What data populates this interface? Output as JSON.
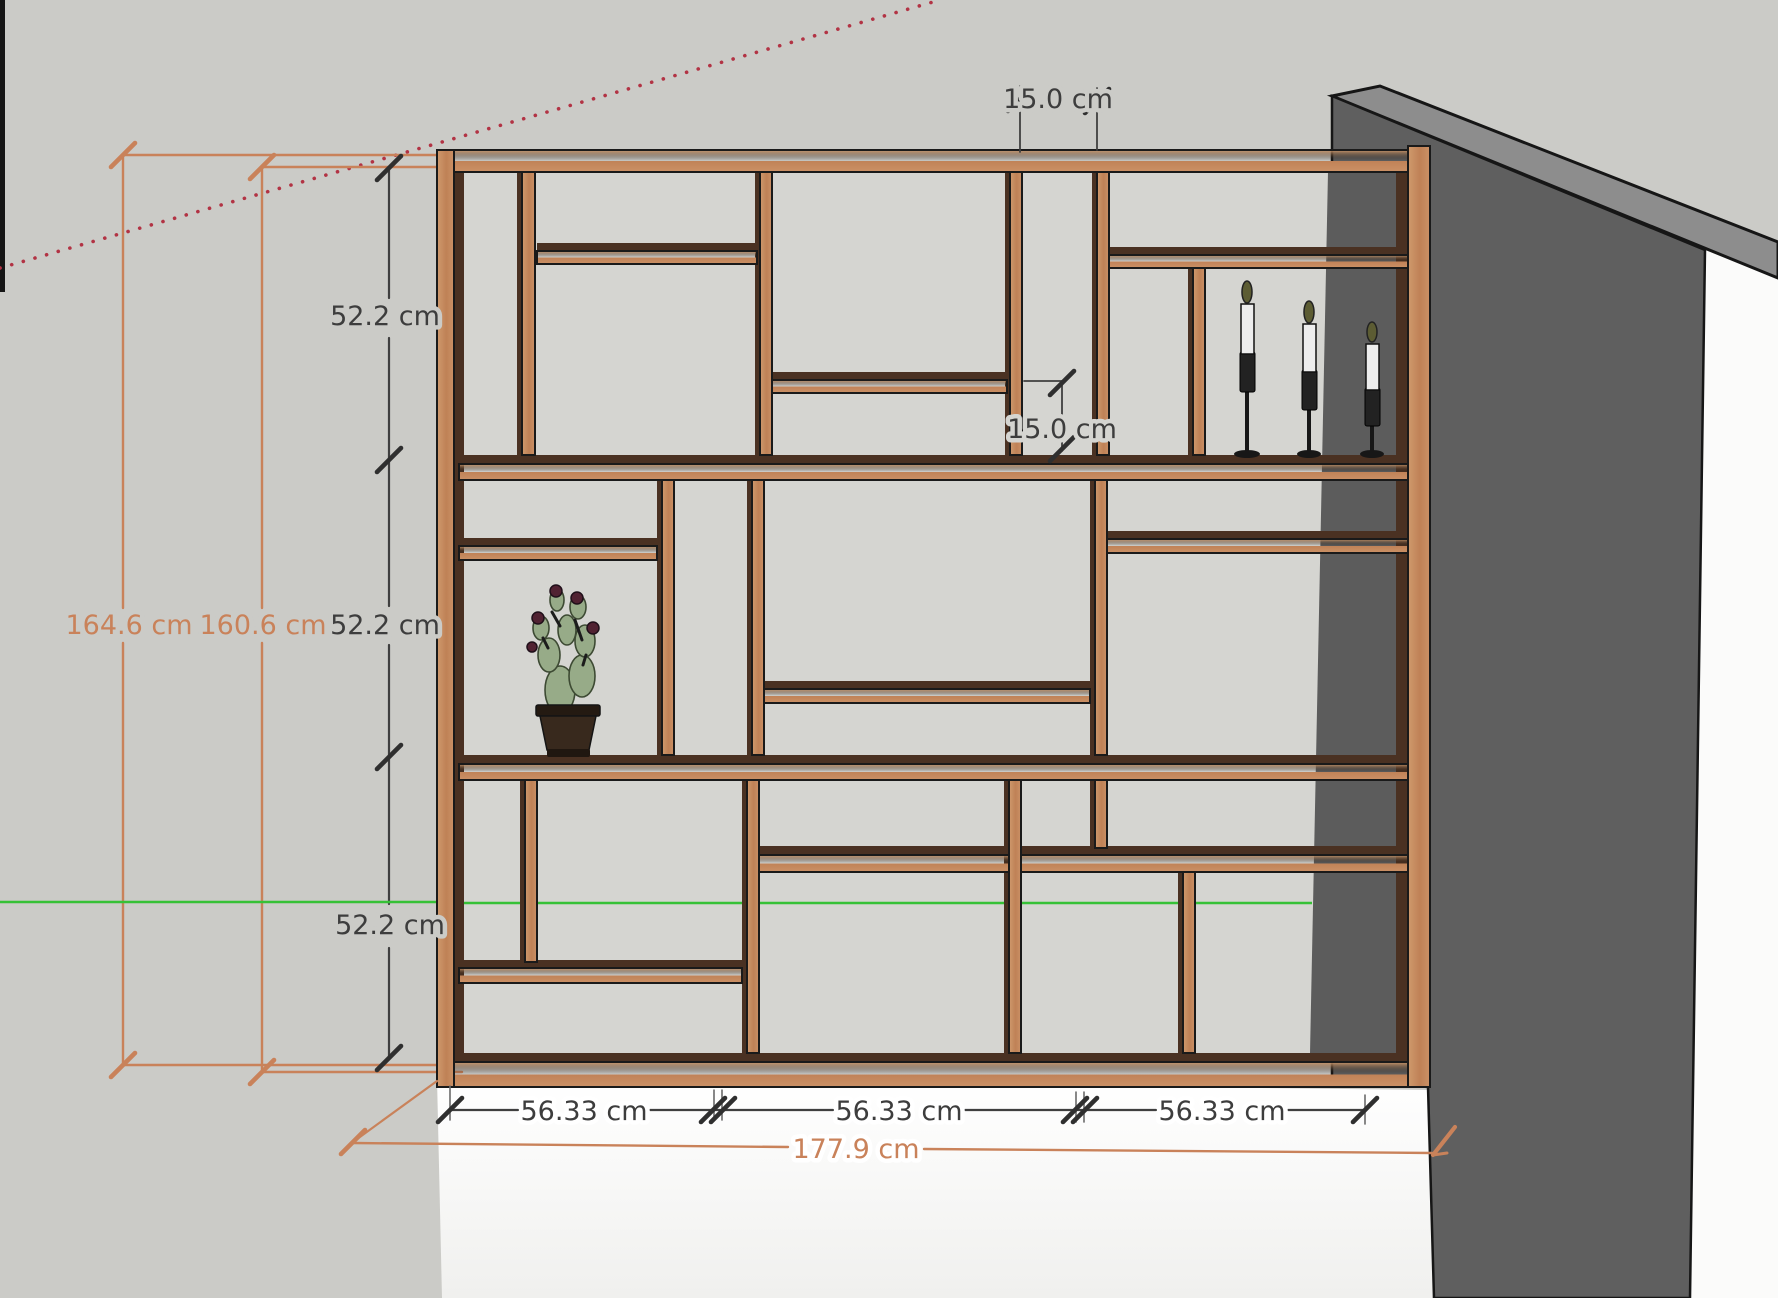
{
  "scene": {
    "objects": [
      "wall-mounted-shelf-unit",
      "potted-cactus",
      "three-candlesticks",
      "wall",
      "floor"
    ],
    "style": "sketchup-3d-model-view"
  },
  "dimensions": {
    "top_niche_width": "15.0 cm",
    "middle_niche_height": "15.0 cm",
    "row_heights": [
      "52.2 cm",
      "52.2 cm",
      "52.2 cm"
    ],
    "overall_height": "164.6 cm",
    "inner_height": "160.6 cm",
    "column_widths": [
      "56.33 cm",
      "56.33 cm",
      "56.33 cm"
    ],
    "overall_width": "177.9 cm"
  },
  "colors": {
    "background": "#cbcbc7",
    "cell_background": "#d5d5d1",
    "wood_face": "#c78e63",
    "wood_shadow": "#4a3122",
    "wall_front": "#5f5f5f",
    "wall_top": "#8d8d8d",
    "floor": "#ffffff",
    "axis_green": "#36c136",
    "guide_red": "#b23344",
    "dimension_orange": "#c9825a",
    "dimension_text": "#3d3d3d"
  }
}
